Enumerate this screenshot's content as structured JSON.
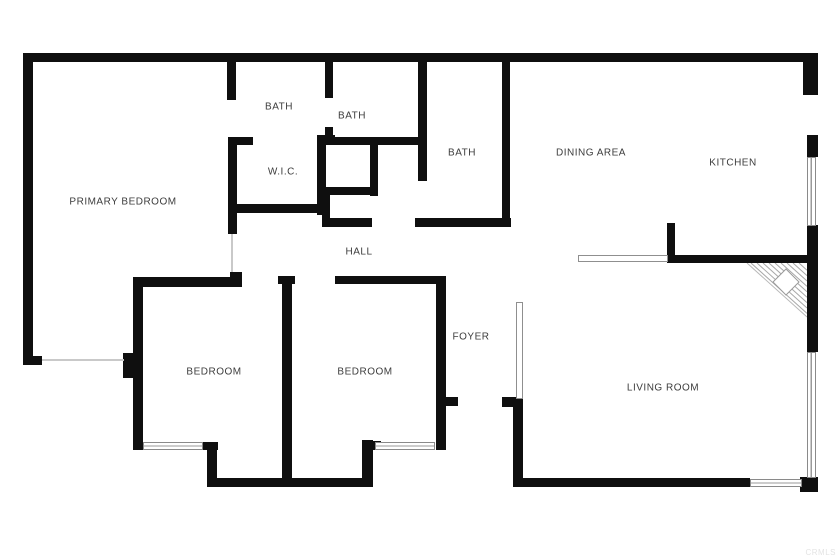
{
  "floorplan": {
    "rooms": {
      "primary_bedroom": "PRIMARY BEDROOM",
      "bath_primary": "BATH",
      "bath_second": "BATH",
      "wic": "W.I.C.",
      "bath_hall": "BATH",
      "dining_area": "DINING AREA",
      "kitchen": "KITCHEN",
      "hall": "HALL",
      "bedroom_left": "BEDROOM",
      "bedroom_right": "BEDROOM",
      "foyer": "FOYER",
      "living_room": "LIVING ROOM"
    },
    "watermark": "CRMLS",
    "colors": {
      "wall": "#0f0f0f",
      "label_text": "#3c3c3c",
      "window_outline": "#8a8a8a",
      "background": "#ffffff"
    },
    "features": {
      "stairs": "corner-winder-stairs",
      "windows": 5,
      "door_leaf": "foyer-open-door",
      "counter": "kitchen-peninsula"
    }
  }
}
